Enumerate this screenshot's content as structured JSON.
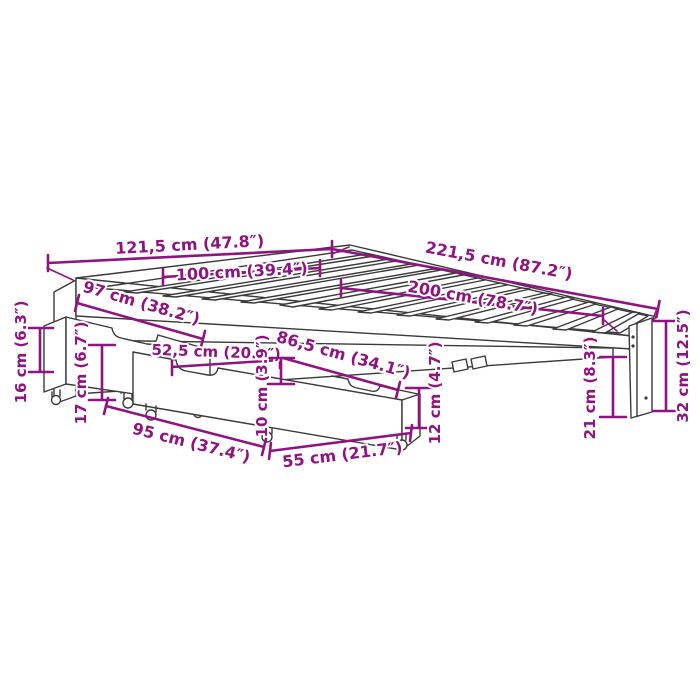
{
  "diagram": {
    "title": "bed-frame-with-storage-drawers-dimension-diagram",
    "background_color": "#ffffff",
    "line_art_color": "#3a3a3a",
    "dimension_color": "#8f1380",
    "dimensions": {
      "overall_width": "121,5 cm (47.8″)",
      "overall_length": "221,5 cm (87.2″)",
      "mattress_width": "100 cm (39.4″)",
      "mattress_length": "200 cm (78.7″)",
      "side_drawer_length": "97 cm (38.2″)",
      "front_drawer_length": "52,5 cm (20.7″)",
      "front_rail_length": "86,5 cm (34.1″)",
      "side_drawer_height": "16 cm (6.3″)",
      "side_rail_height": "17 cm (6.7″)",
      "drawer_side_height": "10 cm (3.9″)",
      "underside_clearance": "12 cm (4.7″)",
      "drawer_bottom_length": "95 cm (37.4″)",
      "drawer_depth": "55 cm (21.7″)",
      "foot_clearance": "21 cm (8.3″)",
      "overall_height": "32 cm (12.5″)"
    }
  }
}
